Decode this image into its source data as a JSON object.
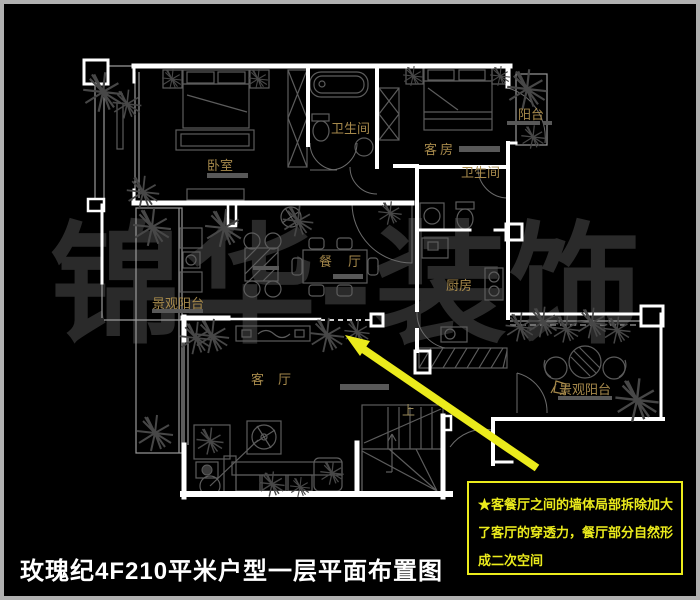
{
  "meta": {
    "kind": "cad-floor-plan-presentation"
  },
  "colors": {
    "background": "#000000",
    "frame_border": "#b0b0b0",
    "wall_white": "#ffffff",
    "furniture_gray": "#5c5c5c",
    "watermark_gray": "#2a2a2a",
    "label_gold": "#a6894b",
    "annotation_yellow": "#ebeb1c",
    "title_white": "#ffffff"
  },
  "watermark": {
    "text": "锦华-装饰"
  },
  "title": {
    "text": "玫瑰纪4F210平米户型一层平面布置图"
  },
  "plan": {
    "labels": [
      {
        "id": "bedroom",
        "text": "卧室"
      },
      {
        "id": "bathroom-1",
        "text": "卫生间"
      },
      {
        "id": "guest-room",
        "text": "客房"
      },
      {
        "id": "balcony-top",
        "text": "阳台"
      },
      {
        "id": "bathroom-2",
        "text": "卫生间"
      },
      {
        "id": "dining-room",
        "text": "餐厅"
      },
      {
        "id": "kitchen",
        "text": "厨房"
      },
      {
        "id": "balcony-left",
        "text": "景观阳台"
      },
      {
        "id": "living-room",
        "text": "客厅"
      },
      {
        "id": "balcony-right",
        "text": "景观阳台"
      },
      {
        "id": "stairs-up",
        "text": "上"
      }
    ]
  },
  "annotation": {
    "lines": [
      "★客餐厅之间的墙体局部拆除加大",
      "了客厅的穿透力，餐厅部分自然形",
      "成二次空间"
    ]
  }
}
